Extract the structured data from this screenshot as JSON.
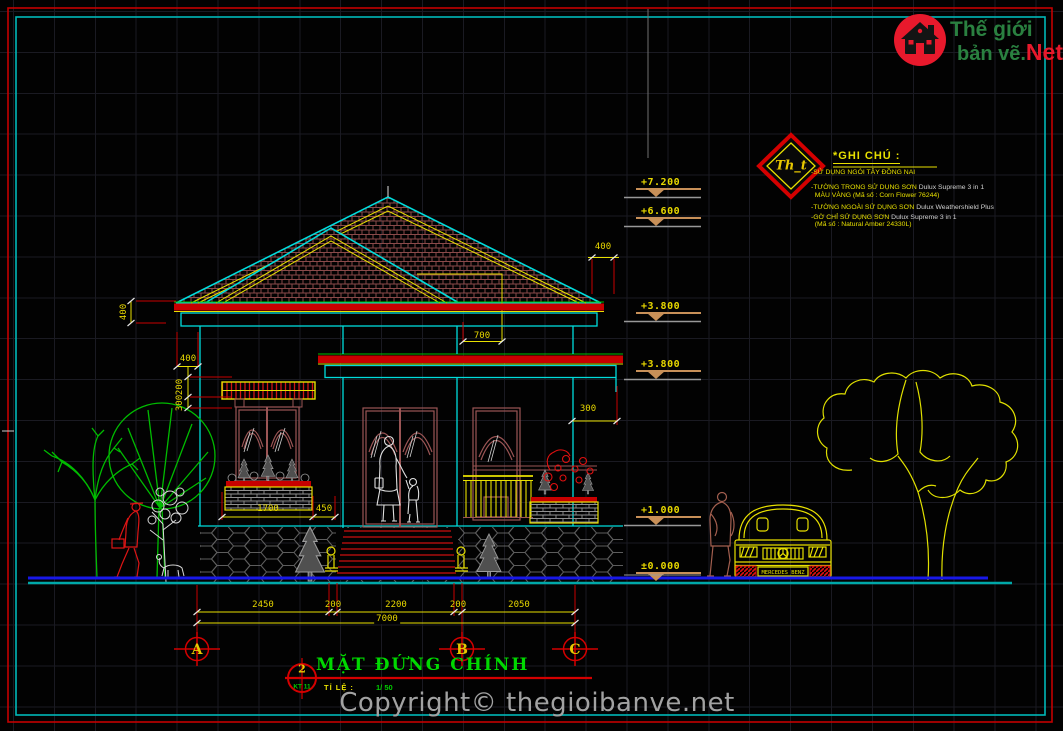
{
  "header_logo": {
    "brand_line1": "Thế giới",
    "brand_line2": "bản vẽ.",
    "brand_suffix": "Net"
  },
  "stamp": {
    "label": "Th_t"
  },
  "notes": {
    "title": "*GHI CHÚ :",
    "items": [
      {
        "main": "-SỬ DỤNG NGÓI TÂY ĐỒNG NAI",
        "product": ""
      },
      {
        "main": "-TƯỜNG TRONG SỬ DỤNG SƠN ",
        "product": "Dulux Supreme 3 in 1"
      },
      {
        "main": "  MÀU VÀNG (Mã số : Corn Flower 76244)",
        "product": ""
      },
      {
        "main": "-TƯỜNG NGOÀI SỬ DỤNG SƠN ",
        "product": "Dulux Weathershield Plus"
      },
      {
        "main": "-GỜ CHỈ SỬ DỤNG SƠN ",
        "product": "Dulux Supreme 3 in 1"
      },
      {
        "main": "  (Mã số : Natural Amber 24330L)",
        "product": ""
      }
    ]
  },
  "levels": [
    {
      "value": "+7.200"
    },
    {
      "value": "+6.600"
    },
    {
      "value": "+3.800"
    },
    {
      "value": "+3.800"
    },
    {
      "value": "+1.000"
    },
    {
      "value": "±0.000"
    }
  ],
  "dimensions": {
    "roof_overhang_left": "400",
    "roof_overhang_right": "400",
    "porch_ridge_offset": "700",
    "porch_overhang": "300",
    "eave_offset": "400",
    "fascia_upper": "200",
    "fascia_lower": "300",
    "window_width": "1700",
    "window_to_wall": "450",
    "bottom_chain": [
      "2450",
      "200",
      "2200",
      "200",
      "2050"
    ],
    "total_width": "7000"
  },
  "axes": [
    {
      "label": "A"
    },
    {
      "label": "B"
    },
    {
      "label": "C"
    }
  ],
  "title_block": {
    "detail_number": "2",
    "sheet_code": "KT 11",
    "title": "MẶT ĐỨNG CHÍNH",
    "scale_label": "TỈ LỆ :",
    "scale_value": "1/ 50"
  },
  "vehicle": {
    "plate": "MERCEDES BENZ"
  },
  "footer": {
    "copyright": "Copyright© thegioibanve.net"
  },
  "colors": {
    "cad_cyan": "#00dcdc",
    "cad_red": "#d40000",
    "cad_yellow": "#e8e000",
    "cad_green": "#00c000",
    "brand_red": "#e8192c",
    "brand_green": "#2a8040",
    "level_tan": "#c89058",
    "watermark_gray": "#a2a2a2"
  }
}
